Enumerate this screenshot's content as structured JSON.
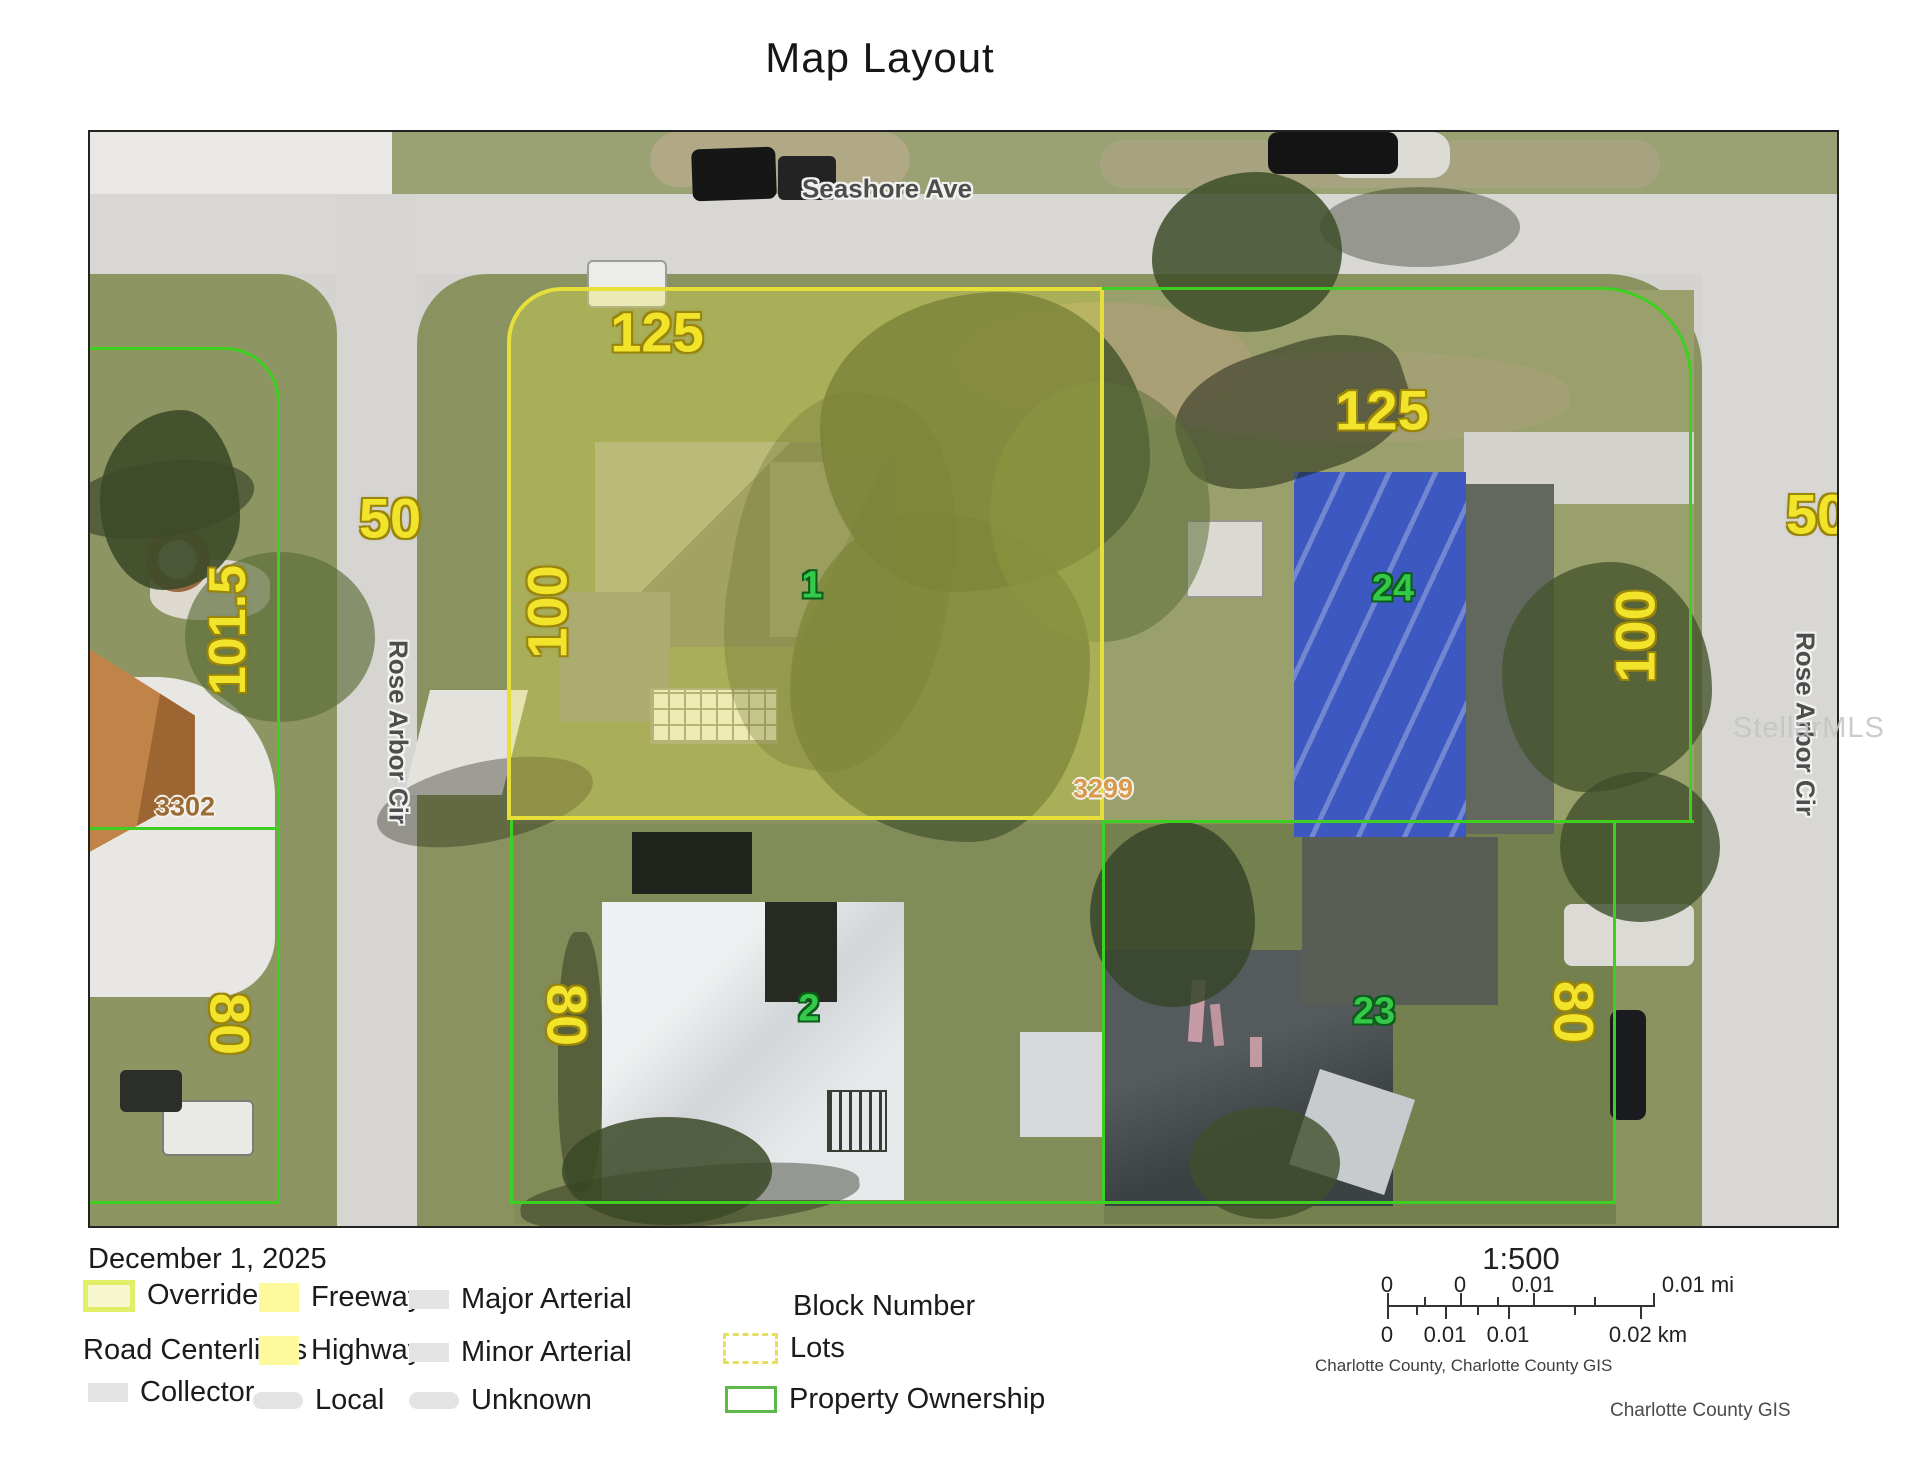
{
  "page": {
    "title": "Map Layout",
    "watermark": "StellarMLS"
  },
  "map": {
    "streets": {
      "top": "Seashore Ave",
      "left": "Rose Arbor Cir",
      "right": "Rose Arbor Cir"
    },
    "dimensions": {
      "lot1_frontage": "125",
      "lot1_depth": "100",
      "lot24_frontage": "125",
      "lot24_depth": "100",
      "left_street_frontage": "50",
      "right_street_frontage": "50",
      "parcel3302_depth": "101.5",
      "parcel3302_lower_depth": "80",
      "lot2_depth": "80",
      "lot23_depth": "80"
    },
    "lot_numbers": {
      "lot1": "1",
      "lot2": "2",
      "lot23": "23",
      "lot24": "24"
    },
    "block_numbers": {
      "left": "3302",
      "right": "3299"
    }
  },
  "legend": {
    "date": "December 1, 2025",
    "items": [
      {
        "label": "Override 1",
        "swatch": "override"
      },
      {
        "label": "Freeway",
        "swatch": "yellow"
      },
      {
        "label": "Major Arterial",
        "swatch": "gray"
      },
      {
        "label": "Block Number",
        "swatch": "none"
      },
      {
        "label": "Road Centerlines",
        "swatch": "none"
      },
      {
        "label": "Highway",
        "swatch": "yellow"
      },
      {
        "label": "Minor Arterial",
        "swatch": "gray"
      },
      {
        "label": "Lots",
        "swatch": "dashed-yellow"
      },
      {
        "label": "Collector",
        "swatch": "gray"
      },
      {
        "label": "Local",
        "swatch": "gray-rounded"
      },
      {
        "label": "Unknown",
        "swatch": "gray-rounded"
      },
      {
        "label": "Property Ownership",
        "swatch": "green-outline"
      }
    ]
  },
  "scalebar": {
    "ratio": "1:500",
    "miles_labels": [
      "0",
      "0",
      "0.01",
      "0.01 mi"
    ],
    "km_labels": [
      "0",
      "0.01",
      "0.01",
      "0.02 km"
    ],
    "source": "Charlotte County, Charlotte County GIS",
    "credit": "Charlotte County GIS"
  },
  "colors": {
    "dim-label": "#f2e32b",
    "lot-label": "#35c94a",
    "parcel-line": "#3ed021",
    "highlight-border": "#e6df3a",
    "highlight-fill": "rgba(234,232,78,0.33)",
    "legend-override-border": "#e2ee68",
    "legend-yellow": "#fcfa9c",
    "legend-gray": "#e3e3e3",
    "legend-green": "#5cb947",
    "lots-dash": "#e5de63",
    "block-left": "#9a6b35",
    "block-right": "#d99a4e",
    "road": "#d6d5d1",
    "grass": "#8a925f"
  }
}
